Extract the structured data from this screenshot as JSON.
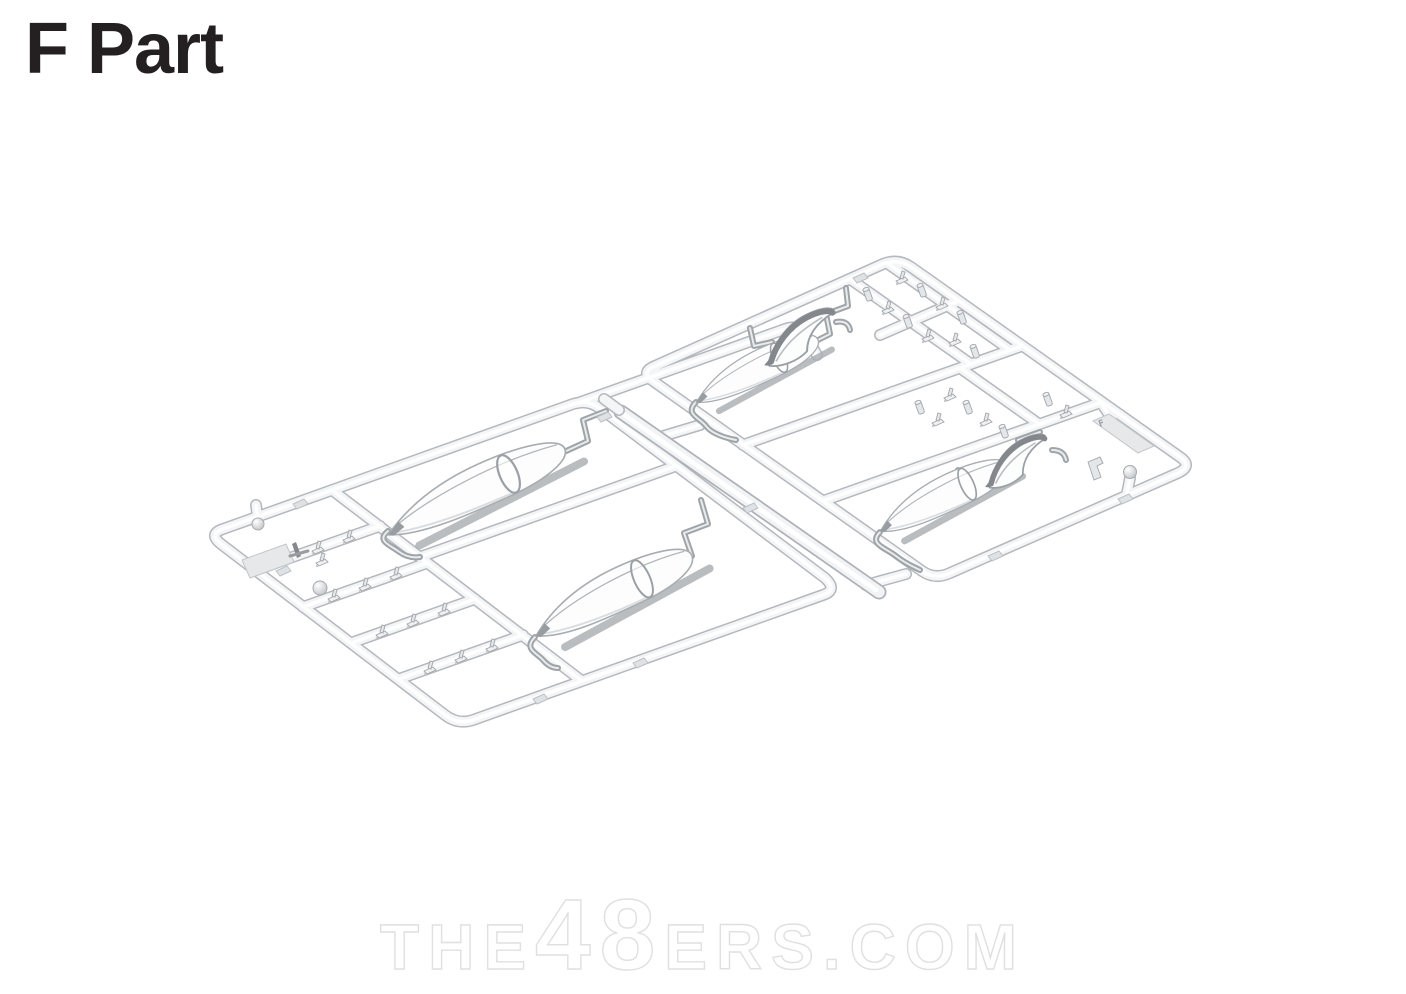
{
  "title": "F Part",
  "title_color": "#242021",
  "sprue": {
    "tag_letter": "F",
    "plastic_color": "#f4f5f7",
    "outline_color": "#b4b8bd",
    "shadow_color": "#a6aaae"
  },
  "watermark": {
    "prefix": "THE",
    "number": "48",
    "suffix": "ERS.COM",
    "color": "#e0e0e0"
  }
}
